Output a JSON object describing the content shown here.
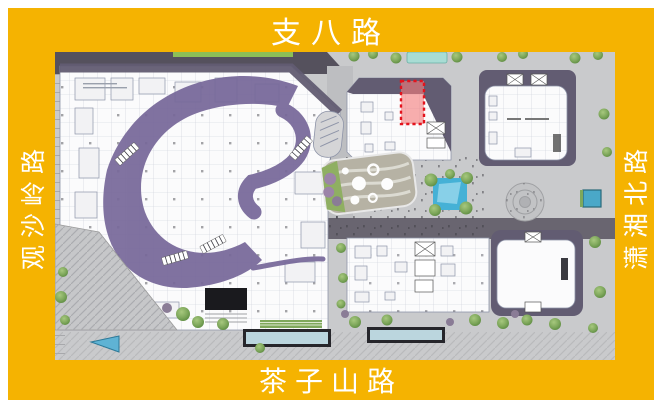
{
  "roads": {
    "top": {
      "label": "支八路"
    },
    "bottom": {
      "label": "茶子山路"
    },
    "left": {
      "label": "观沙岭路"
    },
    "right": {
      "label": "潇湘北路"
    }
  },
  "map": {
    "description_visible": "",
    "highlight_marker": {
      "style": "red dashed rectangle"
    }
  },
  "colors": {
    "frame_yellow": "#F5B301",
    "label_text": "#FFFFFF",
    "map_pavement": "#C9CACC",
    "road_dark": "#55515D",
    "plan_white": "#FBFBFC",
    "plan_line": "#8E94A8",
    "roof_purple": "#625C72",
    "atrium_purple": "#77689A",
    "highlight_red": "#E3131D",
    "highlight_fill": "#F47C7C",
    "water_blue": "#45B1D6",
    "water_light": "#A8DCD4",
    "tree_green": "#7FA85C",
    "hedge_green": "#8CBF57",
    "rock_gray": "#C6C7C9",
    "entrance_black": "#1A1A1E",
    "pool_teal": "#BBD6DE"
  }
}
